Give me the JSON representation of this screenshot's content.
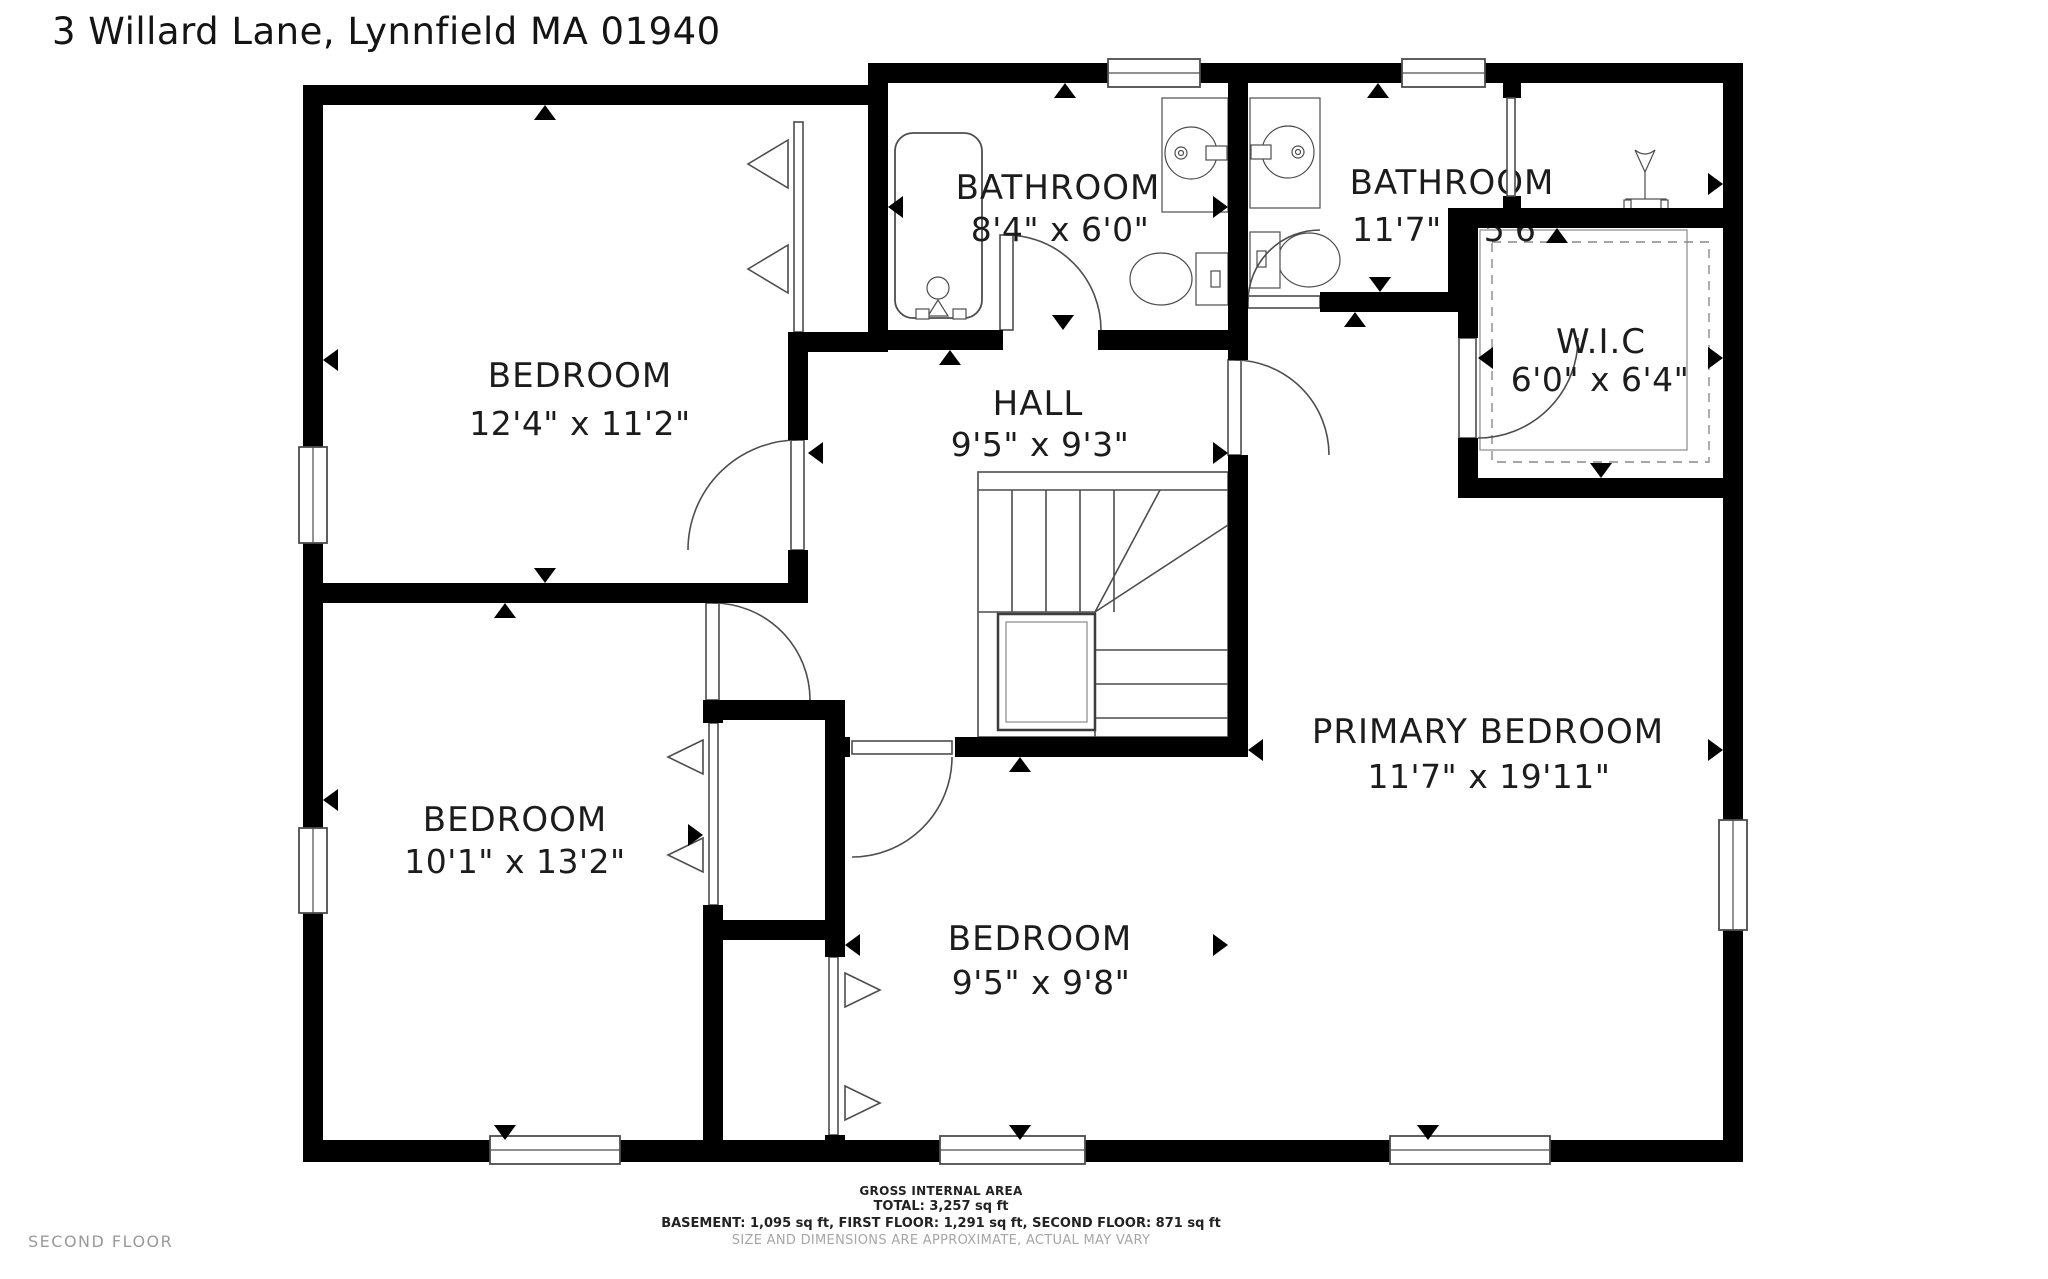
{
  "title": "3 Willard Lane, Lynnfield MA 01940",
  "floor_label": "SECOND FLOOR",
  "footer": {
    "heading": "GROSS INTERNAL AREA",
    "total": "TOTAL: 3,257 sq ft",
    "breakdown": "BASEMENT: 1,095 sq ft, FIRST FLOOR: 1,291 sq ft, SECOND FLOOR: 871 sq ft",
    "disclaimer": "SIZE AND DIMENSIONS ARE APPROXIMATE, ACTUAL MAY VARY"
  },
  "rooms": [
    {
      "id": "bedroom-top-left",
      "name": "BEDROOM",
      "dims": "12'4\" x 11'2\""
    },
    {
      "id": "bathroom-hall",
      "name": "BATHROOM",
      "dims": "8'4\" x 6'0\""
    },
    {
      "id": "bathroom-primary",
      "name": "BATHROOM",
      "dims": "11'7\" x 5'6\""
    },
    {
      "id": "walk-in-closet",
      "name": "W.I.C",
      "dims": "6'0\" x 6'4\""
    },
    {
      "id": "hall",
      "name": "HALL",
      "dims": "9'5\" x 9'3\""
    },
    {
      "id": "primary-bedroom",
      "name": "PRIMARY BEDROOM",
      "dims": "11'7\" x 19'11\""
    },
    {
      "id": "bedroom-bottom-left",
      "name": "BEDROOM",
      "dims": "10'1\" x 13'2\""
    },
    {
      "id": "bedroom-bottom-middle",
      "name": "BEDROOM",
      "dims": "9'5\" x 9'8\""
    }
  ],
  "colors": {
    "wall": "#000000",
    "line": "#4d4d4d",
    "label": "#1c1c1c",
    "muted": "#a6a6a6",
    "floor_tag": "#9a9a9a",
    "background": "#ffffff"
  }
}
